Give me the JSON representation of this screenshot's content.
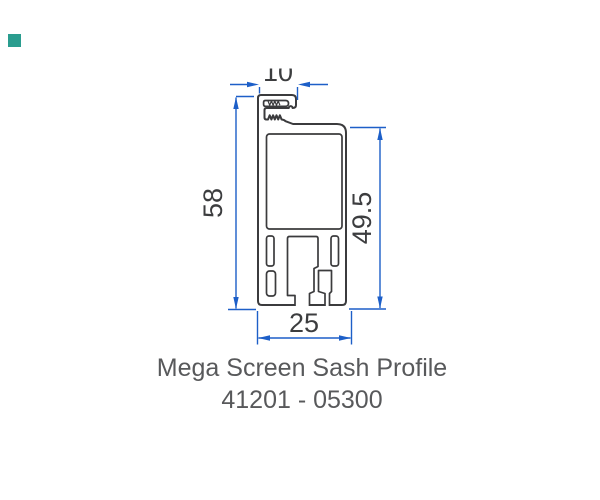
{
  "accent_square": {
    "color": "#2a9d8f"
  },
  "drawing": {
    "name": "aluminum-profile-cross-section",
    "line_color": "#3b3b3d",
    "dimension_color": "#1d5fc8",
    "dimension_text_color": "#3c3d3f",
    "dimensions": {
      "top_width": "10",
      "left_height": "58",
      "right_height": "49.5",
      "bottom_width": "25"
    }
  },
  "title": {
    "line1": "Mega Screen Sash Profile",
    "line2": "41201 - 05300",
    "color": "#58595b"
  }
}
